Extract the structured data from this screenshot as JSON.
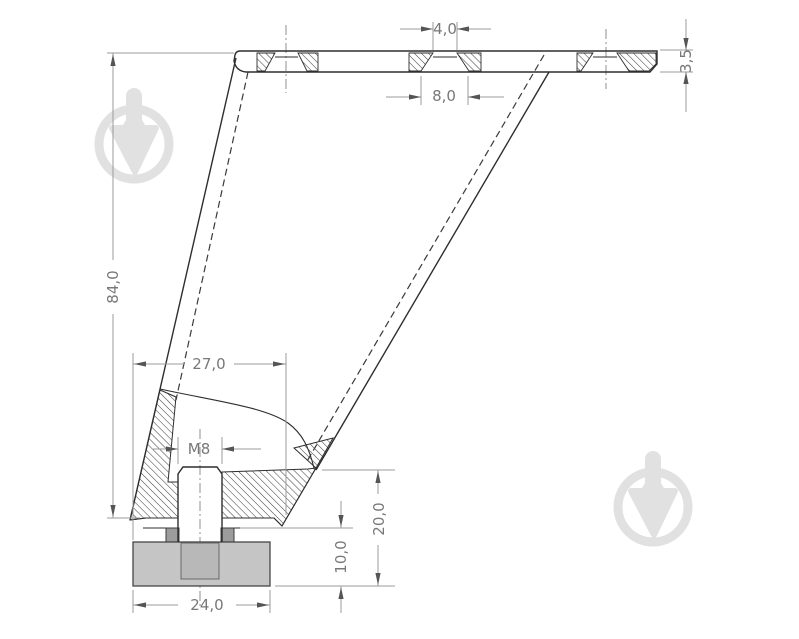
{
  "drawing": {
    "type": "technical-section-drawing",
    "subject": "furniture-leg-profile",
    "dimensions": {
      "slot_top_width": {
        "label": "4,0"
      },
      "slot_flare_width": {
        "label": "8,0"
      },
      "plate_thickness": {
        "label": "3,5"
      },
      "leg_height": {
        "label": "84,0"
      },
      "base_width": {
        "label": "27,0"
      },
      "thread_callout": {
        "label": "M8"
      },
      "foot_height": {
        "label": "10,0"
      },
      "mount_height": {
        "label": "20,0"
      },
      "foot_width": {
        "label": "24,0"
      }
    },
    "colors": {
      "background": "#ffffff",
      "outline": "#2e2e2e",
      "dimension_line": "#9b9b9b",
      "dimension_text": "#787878",
      "foot_fill": "#c5c5c5",
      "stud_in_foot_fill": "#b8b8b8",
      "washer_tab_fill": "#9c9c9c",
      "watermark": "#e1e1e1"
    }
  }
}
